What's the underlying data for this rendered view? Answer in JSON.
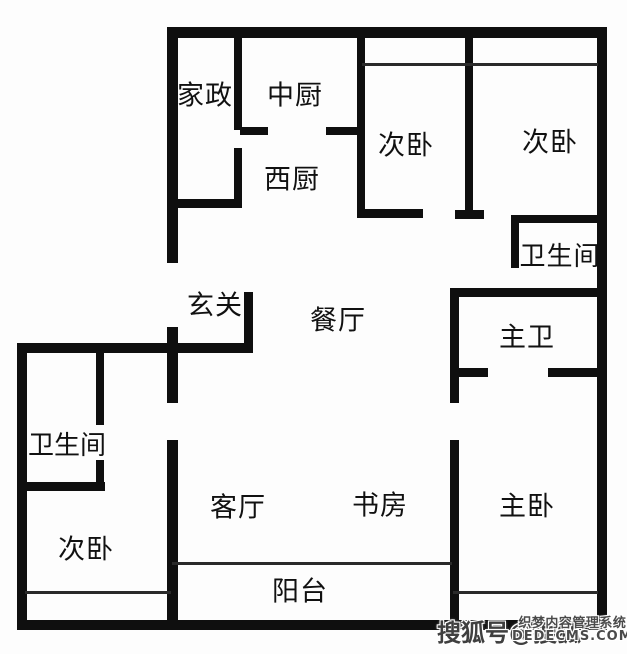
{
  "floorplan": {
    "rooms": [
      {
        "id": "jiazheng",
        "label": "家政"
      },
      {
        "id": "zhongchu",
        "label": "中厨"
      },
      {
        "id": "xichu",
        "label": "西厨"
      },
      {
        "id": "ciwo-top-left",
        "label": "次卧"
      },
      {
        "id": "ciwo-top-right",
        "label": "次卧"
      },
      {
        "id": "weishengjian-top",
        "label": "卫生间"
      },
      {
        "id": "xuanguan",
        "label": "玄关"
      },
      {
        "id": "canting",
        "label": "餐厅"
      },
      {
        "id": "zhuwei",
        "label": "主卫"
      },
      {
        "id": "weishengjian-left",
        "label": "卫生间"
      },
      {
        "id": "keting",
        "label": "客厅"
      },
      {
        "id": "shufang",
        "label": "书房"
      },
      {
        "id": "zhuwo",
        "label": "主卧"
      },
      {
        "id": "ciwo-bottom-left",
        "label": "次卧"
      },
      {
        "id": "yangtai",
        "label": "阳台"
      }
    ],
    "watermark": {
      "sohu": "搜狐号@搜狐",
      "cms_line1": "织梦内容管理系统",
      "cms_line2": "DEDECMS.COM"
    },
    "colors": {
      "wall": "#0f0f0f",
      "background": "#fdfdfd",
      "label_text": "#111111",
      "watermark_text": "#4a4a4a"
    }
  }
}
